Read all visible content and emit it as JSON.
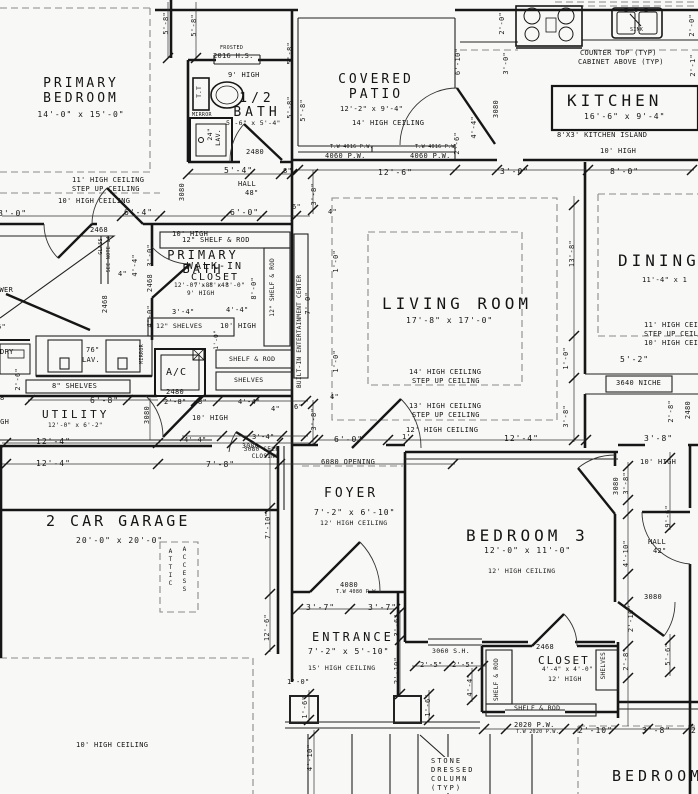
{
  "rooms": {
    "primary_bedroom": {
      "name": "PRIMARY BEDROOM",
      "size": "14'-0\" x 15'-0\""
    },
    "half_bath": {
      "name": "1/2 BATH",
      "size": "5'-6\" x 5'-4\""
    },
    "covered_patio": {
      "name": "COVERED PATIO",
      "size": "12'-2\" x 9'-4\""
    },
    "kitchen": {
      "name": "KITCHEN",
      "size": "16'-6\" x 9'-4\""
    },
    "primary_bath": {
      "name": "PRIMARY BATH",
      "size": "12'-0\" x 8'-4\"",
      "note": "9' HIGH"
    },
    "walk_in_closet": {
      "name": "WALK-IN CLOSET",
      "size": "7'-8\" x 8'-0\""
    },
    "living_room": {
      "name": "LIVING ROOM",
      "size": "17'-8\" x 17'-0\""
    },
    "dining": {
      "name": "DINING",
      "size": "11'-4\" x 1"
    },
    "utility": {
      "name": "UTILITY",
      "size": "12'-0\" x 6'-2\""
    },
    "garage": {
      "name": "2 CAR GARAGE",
      "size": "20'-0\" x 20'-0\""
    },
    "foyer": {
      "name": "FOYER",
      "size": "7'-2\" x 6'-10\"",
      "note": "12' HIGH CEILING"
    },
    "bedroom3": {
      "name": "BEDROOM 3",
      "size": "12'-0\" x 11'-0\"",
      "note": "12' HIGH CEILING"
    },
    "entrance": {
      "name": "ENTRANCE",
      "size": "7'-2\" x 5'-10\"",
      "note": "15' HIGH CEILING"
    },
    "closet3": {
      "name": "CLOSET",
      "size": "4'-4\" x 4'-0\"",
      "note": "12' HIGH"
    },
    "hall_center": {
      "name": "HALL",
      "size": "48\""
    },
    "hall_right": {
      "name": "HALL",
      "size": "42\""
    },
    "bedroom2": {
      "name": "BEDROOM"
    }
  },
  "notes": {
    "frosted": "FROSTED",
    "window2016": "2016 H.S.",
    "h9": "9' HIGH",
    "tt": "T.T",
    "mirror": "MIRROR",
    "lav24": "24\"",
    "lav": "LAV.",
    "lav76": "76\"",
    "counter": "COUNTER TOP (TYP)",
    "cabinet": "CABINET ABOVE (TYP)",
    "sink": "SINK",
    "island": "8'X3' KITCHEN ISLAND",
    "h10": "10' HIGH",
    "tw4016": "T.W 4016 P.W.",
    "pw4060": "4060 P.W.",
    "glass": "GLASS",
    "note14": "SEE NOTE 14",
    "shower": "SHOWER",
    "shelfrod12": "12\" SHELF & ROD",
    "shelves12": "12\" SHELVES",
    "shelfrod": "SHELF & ROD",
    "shelves": "SHELVES",
    "ac": "A/C",
    "shelves8": "8\" SHELVES",
    "builtin": "BUILT-IN ENTERTAINMENT CENTER",
    "laundry": "LAUNDRY",
    "niche": "3640 NICHE",
    "opening6080": "6080 OPENING",
    "selfclosing": "3080 SELF CLOSING",
    "attic1": "ATTIC",
    "attic2": "ACCESS",
    "stone": "STONE DRESSED COLUMN (TYP)",
    "sh3060": "3060 S.H.",
    "pw4080": "T.W 4080 P.W.",
    "pw2020": "2020 P.W.",
    "tw2020": "T.W 2020 P.W.",
    "ceil11": "11' HIGH CEILING",
    "stepup": "STEP UP CEILING",
    "ceil10": "10' HIGH CEILING",
    "ceil14": "14' HIGH CEILING",
    "ceil13": "13' HIGH CEILING",
    "ceil12": "12' HIGH CEILING"
  },
  "dims": {
    "d5_8": "5'-8\"",
    "d6_10": "6'-10\"",
    "d2_0": "2'-0\"",
    "d3_0": "3'-0\"",
    "d2_1": "2'-1\"",
    "n2480": "2480",
    "d5_4": "5'-4\"",
    "d8in": "8\"",
    "d12_6": "12'-6\"",
    "d8_0": "8'-0\"",
    "d2_6": "2'-6\"",
    "d4_4": "4'-4\"",
    "n3080": "3080",
    "d6_4": "6'-4\"",
    "n2468": "2468",
    "d6_0": "6'-0\"",
    "d6in": "6\"",
    "d3_8": "3'-8\"",
    "d4in": "4\"",
    "d1_0": "1'-0\"",
    "d7_0": "7'-0\"",
    "d13_8": "13'-8\"",
    "d12_4": "12'-4\"",
    "d3_4": "3'-4\"",
    "d2_8": "2'-8\"",
    "d6_8": "6'-8\"",
    "d5_2": "5'-2\"",
    "d1ft": "1'",
    "d7_8": "7'-8\"",
    "d7_10": "7'-10\"",
    "d3_7": "3'-7\"",
    "n4080": "4080",
    "d3_6": "3'-6\"",
    "d2_10": "2'-10\"",
    "d1_6": "1'-6\"",
    "d4_10": "4'-10\"",
    "d2_5": "2'-5\"",
    "d9_6": "9'-6\"",
    "d5_6": "5'-6\"",
    "d4_0": "4'-0\"",
    "d2frag": "2"
  }
}
